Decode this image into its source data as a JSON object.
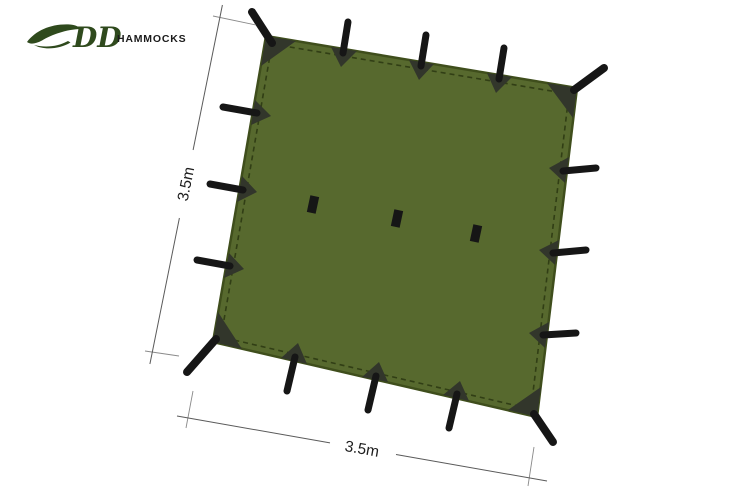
{
  "logo": {
    "brand": "DD",
    "name": "HAMMOCKS"
  },
  "diagram": {
    "product": "square tarp plan view",
    "width_label": "3.5m",
    "height_label": "3.5m",
    "perimeter_attachment_points": 16,
    "center_attachment_points": 3
  },
  "colors": {
    "page_bg": "#ffffff",
    "tarp_green": "#57692E",
    "tarp_edge": "#3F4E1C",
    "hem_stitch": "#2A3711",
    "webbing_patch": "#32362B",
    "strap_black": "#161616",
    "dim_line": "#5a5a5a",
    "ext_line": "#8a8a8a",
    "dim_text": "#1e1e1e",
    "logo_green": "#2F4A1D",
    "logo_text": "#1b1b1b"
  }
}
